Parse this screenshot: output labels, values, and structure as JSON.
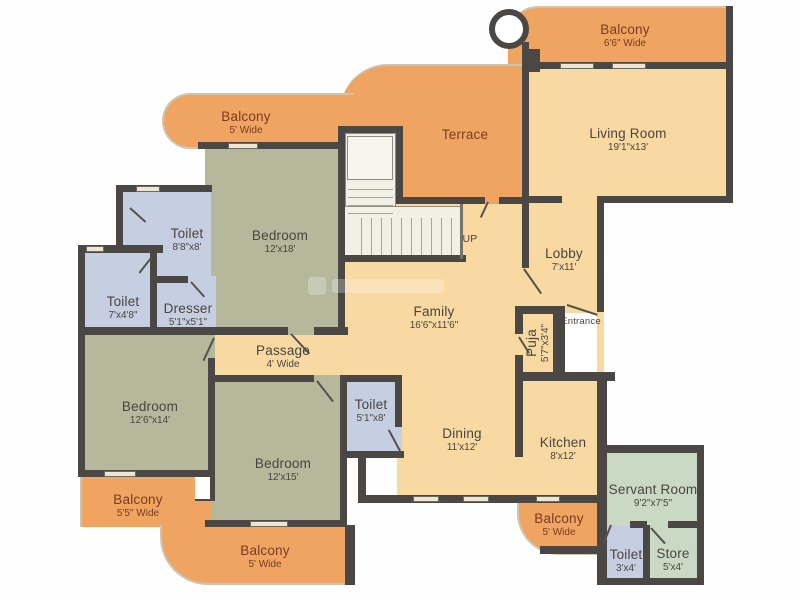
{
  "palette": {
    "wall": "#4b4744",
    "floor": "#f7d9a1",
    "balcony": "#efa561",
    "bedroom": "#b5b89b",
    "toilet": "#c6cfe2",
    "servant": "#c9d9c4",
    "stair": "#f2efe4",
    "room_text": "#4a4540",
    "balcony_text": "#7b3a22"
  },
  "rooms": {
    "balcony_top_right": {
      "label": "Balcony",
      "dims": "6'6\" Wide"
    },
    "living_room": {
      "label": "Living Room",
      "dims": "19'1\"x13'"
    },
    "terrace": {
      "label": "Terrace",
      "dims": ""
    },
    "balcony_top_left": {
      "label": "Balcony",
      "dims": "5' Wide"
    },
    "lobby": {
      "label": "Lobby",
      "dims": "7'x11'"
    },
    "bedroom_top": {
      "label": "Bedroom",
      "dims": "12'x18'"
    },
    "toilet_top": {
      "label": "Toilet",
      "dims": "8'8\"x8'"
    },
    "toilet_left": {
      "label": "Toilet",
      "dims": "7'x4'8\""
    },
    "dresser": {
      "label": "Dresser",
      "dims": "5'1\"x5'1\""
    },
    "family": {
      "label": "Family",
      "dims": "16'6\"x11'6\""
    },
    "passage": {
      "label": "Passage",
      "dims": "4' Wide"
    },
    "puja": {
      "label": "Puja",
      "dims": "5'7\"x3'4\""
    },
    "bedroom_left": {
      "label": "Bedroom",
      "dims": "12'6\"x14'"
    },
    "bedroom_bottom": {
      "label": "Bedroom",
      "dims": "12'x15'"
    },
    "toilet_mid": {
      "label": "Toilet",
      "dims": "5'1\"x8'"
    },
    "dining": {
      "label": "Dining",
      "dims": "11'x12'"
    },
    "kitchen": {
      "label": "Kitchen",
      "dims": "8'x12'"
    },
    "servant_room": {
      "label": "Servant Room",
      "dims": "9'2\"x7'5\""
    },
    "toilet_servant": {
      "label": "Toilet",
      "dims": "3'x4'"
    },
    "store": {
      "label": "Store",
      "dims": "5'x4'"
    },
    "balcony_bottom_left": {
      "label": "Balcony",
      "dims": "5'5\" Wide"
    },
    "balcony_bottom": {
      "label": "Balcony",
      "dims": "5' Wide"
    },
    "balcony_bottom_mid": {
      "label": "Balcony",
      "dims": "5' Wide"
    }
  },
  "annotations": {
    "entrance": "Entrance",
    "up": "UP"
  }
}
